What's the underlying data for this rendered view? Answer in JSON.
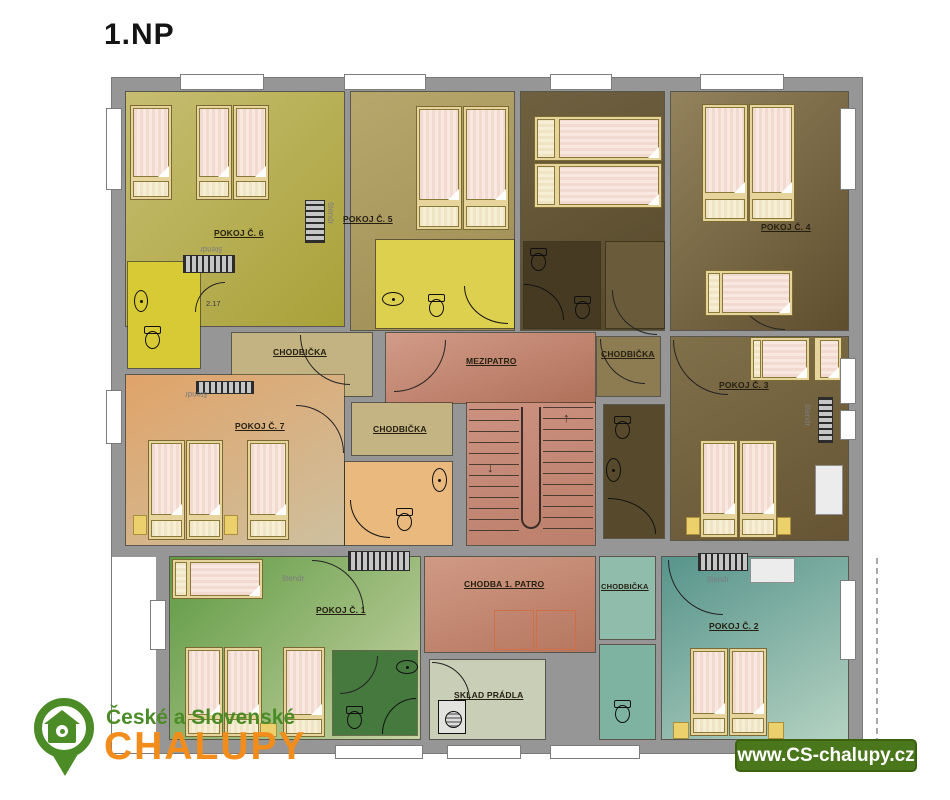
{
  "title": "1.NP",
  "labels": {
    "pokoj1": "POKOJ Č. 1",
    "pokoj2": "POKOJ Č. 2",
    "pokoj3": "POKOJ Č. 3",
    "pokoj4": "POKOJ Č. 4",
    "pokoj5": "POKOJ Č. 5",
    "pokoj6": "POKOJ Č. 6",
    "pokoj7": "POKOJ Č. 7",
    "chodbicka": "CHODBIČKA",
    "mezipatro": "MEZIPATRO",
    "chodba": "CHODBA 1. PATRO",
    "sklad": "SKLAD PRÁDLA",
    "stendr": "štendr",
    "room_number": "2.17"
  },
  "stairs": {
    "up_arrow": "↑",
    "down_arrow": "↓"
  },
  "branding": {
    "line1": "České a Slovenské",
    "line2": "CHALUPY",
    "url": "www.CS-chalupy.cz"
  },
  "colors": {
    "wall_gray": "#969696",
    "accent_green": "#4c8c26",
    "accent_orange": "#f28c1a",
    "badge_green": "#4a761c",
    "mezipatro_salmon": "#c58a74",
    "pokoj1_green": "#74a457",
    "pokoj2_teal": "#5f9a8e",
    "pokoj3_brown": "#746343",
    "pokoj4_brown": "#7c6a45",
    "pokoj5_olive": "#ac9c62",
    "pokoj6_yellow": "#b2aa48",
    "pokoj7_peach": "#d8a570",
    "sklad_pale": "#c9cfb6",
    "bath_yellow": "#d8ca35"
  }
}
